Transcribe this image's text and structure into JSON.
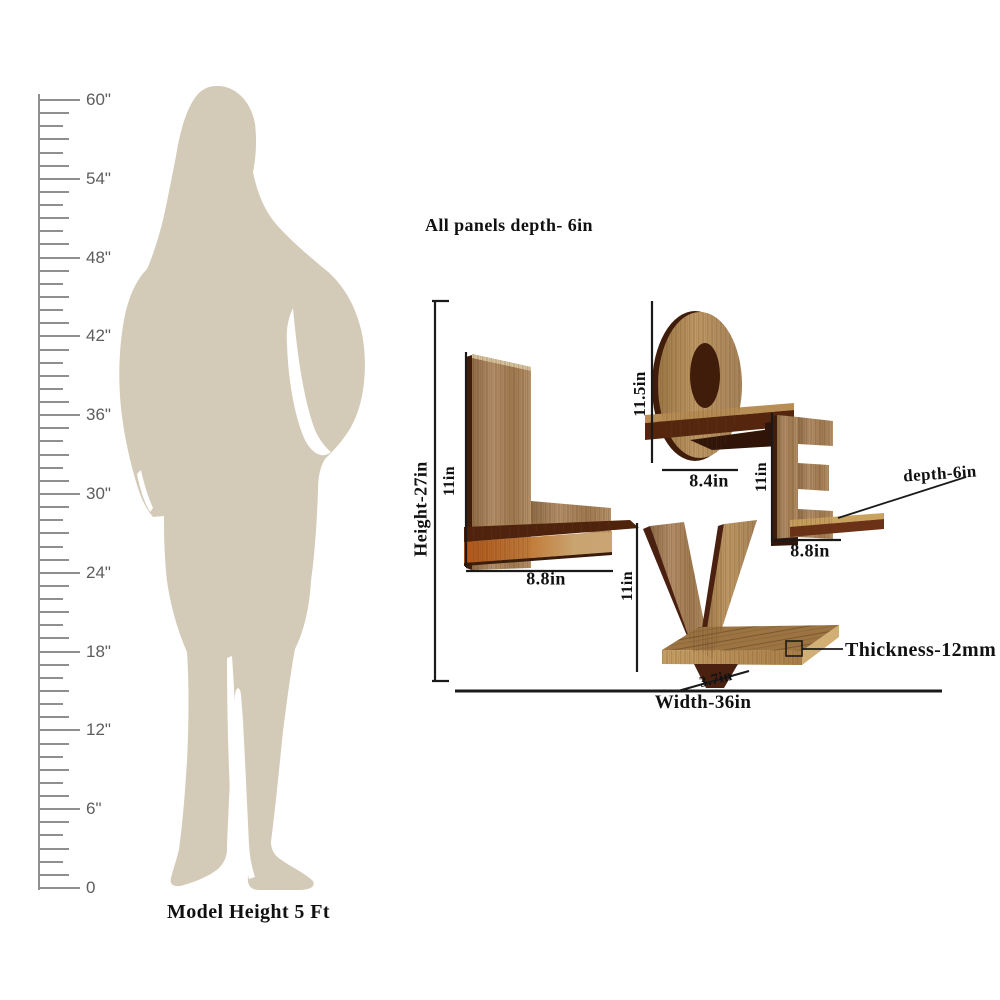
{
  "scene": {
    "background": "#ffffff"
  },
  "ruler": {
    "unit_labels": [
      "60\"",
      "54\"",
      "48\"",
      "42\"",
      "36\"",
      "30\"",
      "24\"",
      "18\"",
      "12\"",
      "6\"",
      "0"
    ],
    "line_color": "#8f8f8f",
    "label_color": "#5d5d5d"
  },
  "model": {
    "caption": "Model Height 5 Ft",
    "silhouette_color": "#d3cbb7"
  },
  "shelf_diagram": {
    "note": "All panels depth- 6in",
    "word": "LOVE",
    "dimensions": {
      "height": "Height-27in",
      "width": "Width-36in",
      "thickness": "Thickness-12mm",
      "depth": "depth-6in",
      "l_height": "11in",
      "l_shelf_width": "8.8in",
      "o_height": "11.5in",
      "o_shelf_width": "8.4in",
      "e_height": "11in",
      "e_shelf_width": "8.8in",
      "v_height": "11in",
      "v_shelf_width": "3.7in"
    },
    "colors": {
      "wood_light": "#b5906a",
      "wood_gold": "#b7915c",
      "wood_dark_edge": "#4a2110",
      "shelf_dark": "#4f220c",
      "shelf_orange": "#b45a1c",
      "dimension_line": "#1a1a1a"
    }
  }
}
